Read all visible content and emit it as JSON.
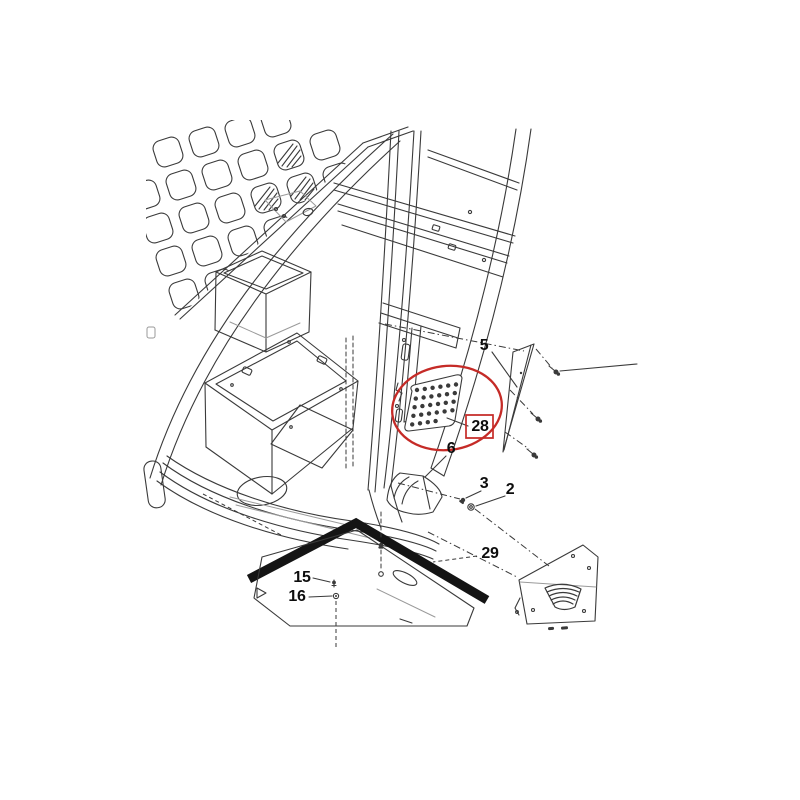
{
  "diagram": {
    "type": "exploded-parts-diagram",
    "subject": "cab-assembly-line-drawing",
    "background_color": "#ffffff",
    "line_color": "#3a3a3a",
    "highlight_color": "#c52b27",
    "strip_color": "#141414",
    "label_color": "#0d0d0d"
  },
  "part_labels": [
    {
      "text": "5",
      "x": 484,
      "y": 346,
      "highlighted": false
    },
    {
      "text": "28",
      "x": 480,
      "y": 427,
      "highlighted": true
    },
    {
      "text": "6",
      "x": 451,
      "y": 449,
      "highlighted": false
    },
    {
      "text": "3",
      "x": 484,
      "y": 484,
      "highlighted": false
    },
    {
      "text": "2",
      "x": 510,
      "y": 490,
      "highlighted": false
    },
    {
      "text": "29",
      "x": 490,
      "y": 554,
      "highlighted": false
    },
    {
      "text": "15",
      "x": 302,
      "y": 578,
      "highlighted": false
    },
    {
      "text": "16",
      "x": 297,
      "y": 597,
      "highlighted": false
    }
  ],
  "highlight_annotation": {
    "shape": "ellipse",
    "boxed_label": "28"
  }
}
